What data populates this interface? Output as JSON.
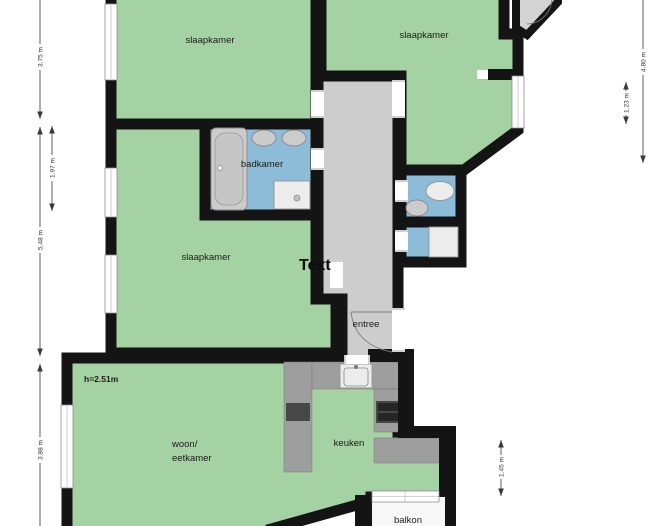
{
  "rooms": {
    "bedroom_top_left": {
      "label": "slaapkamer"
    },
    "bedroom_top_right": {
      "label": "slaapkamer"
    },
    "bedroom_left": {
      "label": "slaapkamer"
    },
    "bathroom": {
      "label": "badkamer"
    },
    "hall": {
      "label": "entree"
    },
    "living_dining": {
      "label_line1": "woon/",
      "label_line2": "eetkamer",
      "height_note": "h=2.51m"
    },
    "kitchen": {
      "label": "keuken"
    },
    "balcony": {
      "label": "balkon"
    }
  },
  "annotations": {
    "text_placeholder": "Text"
  },
  "dimensions": {
    "left_top": "3.75 m",
    "left_inner": "1.97 m",
    "left_middle": "5.48 m",
    "left_bottom": "3.88 m",
    "right_top": "4.80 m",
    "right_top_inner": "1.23 m",
    "right_bottom": "1.45 m"
  },
  "colors": {
    "room_fill": "#a5d2a2",
    "wet_room_fill": "#8cbcd8",
    "hall_fill": "#cdcdcd",
    "counter_fill": "#9e9e9e",
    "appliance_fill": "#474747",
    "wall": "#141414",
    "dimension_line": "#4a4a4a"
  }
}
